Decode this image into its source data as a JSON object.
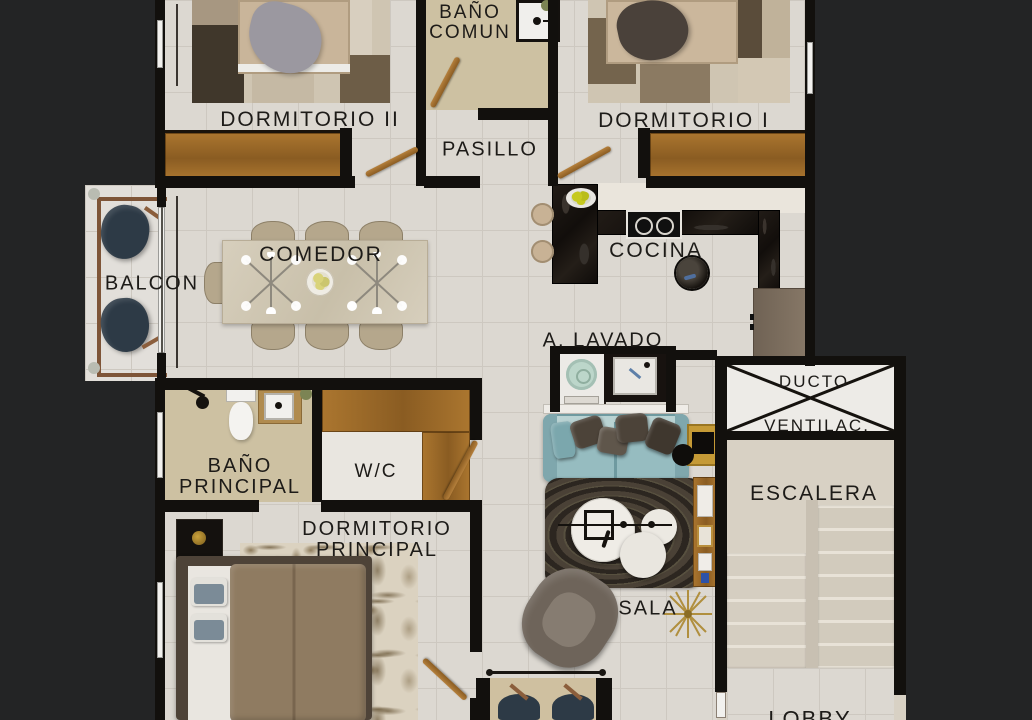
{
  "scene": {
    "type": "apartment-floor-plan-render",
    "view": "top-down 3D rendered floor plan, cropped at top and bottom, on dark background"
  },
  "rooms": {
    "dormitorio_ii": "DORMITORIO II",
    "bano_comun_line1": "BAÑO",
    "bano_comun_line2": "COMUN",
    "dormitorio_i": "DORMITORIO I",
    "pasillo": "PASILLO",
    "balcon": "BALCON",
    "comedor": "COMEDOR",
    "cocina": "COCINA",
    "a_lavado": "A. LAVADO",
    "ducto": "DUCTO",
    "ventilac": "VENTILAC.",
    "escalera": "ESCALERA",
    "bano_principal_line1": "BAÑO",
    "bano_principal_line2": "PRINCIPAL",
    "wc": "W/C",
    "dormitorio_principal_line1": "DORMITORIO",
    "dormitorio_principal_line2": "PRINCIPAL",
    "sala": "SALA",
    "lobby": "LOBBY"
  },
  "colors": {
    "bg": "#232425",
    "floor": "#dcd8d1",
    "grout": "#cdc8c0",
    "wall": "#12100d",
    "beige": "#cdc1a2",
    "beige2": "#d8d1c4",
    "white-floor": "#e9e6e0",
    "wood": "#ab762f",
    "wood-dark": "#8a5c22",
    "counter-dark": "#16110e",
    "fridge": "#7e7060",
    "sofa": "#96bcc0",
    "sofa-light": "#bad3d3",
    "pillow": "#4c4339",
    "navy": "#2d3a46",
    "table": "#d2c9b5",
    "chair": "#b5a78c",
    "rug-dark": "#38312a",
    "rug-cream": "#d8cfbd",
    "gold": "#c59a36",
    "duvet": "#8f7b61",
    "drape": "#9b98a0",
    "bedframe": "#4e4338",
    "mint": "#bcd6ca"
  }
}
